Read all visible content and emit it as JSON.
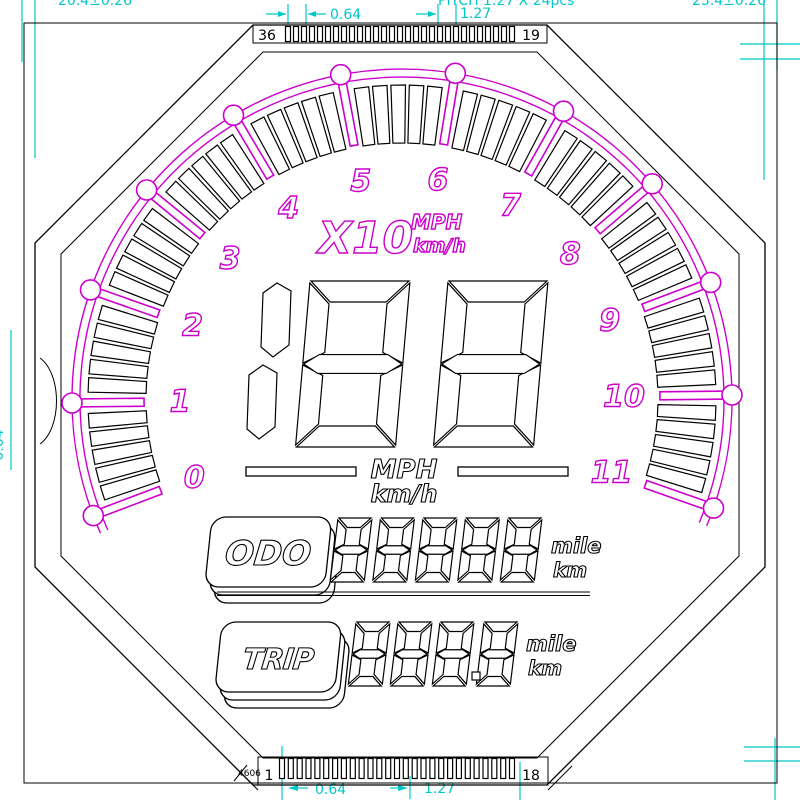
{
  "colors": {
    "background": "#ffffff",
    "line": "#000000",
    "magenta": "#cc00cc",
    "cyan": "#00c8c8"
  },
  "annotations": {
    "top_dim_small": "0.64",
    "top_dim_large": "1.27",
    "bottom_dim_small": "0.64",
    "bottom_dim_large": "1.27",
    "top_cut_left": "20.4±0.26",
    "top_cut_center": "PITCH 1.27 X 24pcs",
    "top_cut_right": "23.4±0.26",
    "left_vertical_dim": "0.64",
    "part_note": "4606"
  },
  "connector": {
    "top": {
      "left_pin": "36",
      "right_pin": "19",
      "ticks": 29
    },
    "bottom": {
      "left_pin": "1",
      "right_pin": "18",
      "ticks": 27
    }
  },
  "dial": {
    "cx": 402,
    "cy": 399,
    "start_angle": 200.7,
    "step": -20,
    "numbers": [
      "0",
      "1",
      "2",
      "3",
      "4",
      "5",
      "6",
      "7",
      "8",
      "9",
      "10",
      "11"
    ],
    "segments_per_interval": 5,
    "r_number": 222,
    "r_seg_in": 256,
    "r_seg_out": 314,
    "r_arc1": 322,
    "r_arc2": 330,
    "r_dot": 330,
    "r_bar_in": 258,
    "r_bar_out": 337,
    "multiplier": "X10",
    "unit_top": "MPH",
    "unit_bottom": "km/h"
  },
  "speed": {
    "digits": "188",
    "unit_top": "MPH",
    "unit_bottom": "km/h"
  },
  "odometer": {
    "label": "ODO",
    "digits": "88888",
    "unit_top": "mile",
    "unit_bottom": "km"
  },
  "trip": {
    "label": "TRIP",
    "digits": "888.8",
    "unit_top": "mile",
    "unit_bottom": "km"
  }
}
